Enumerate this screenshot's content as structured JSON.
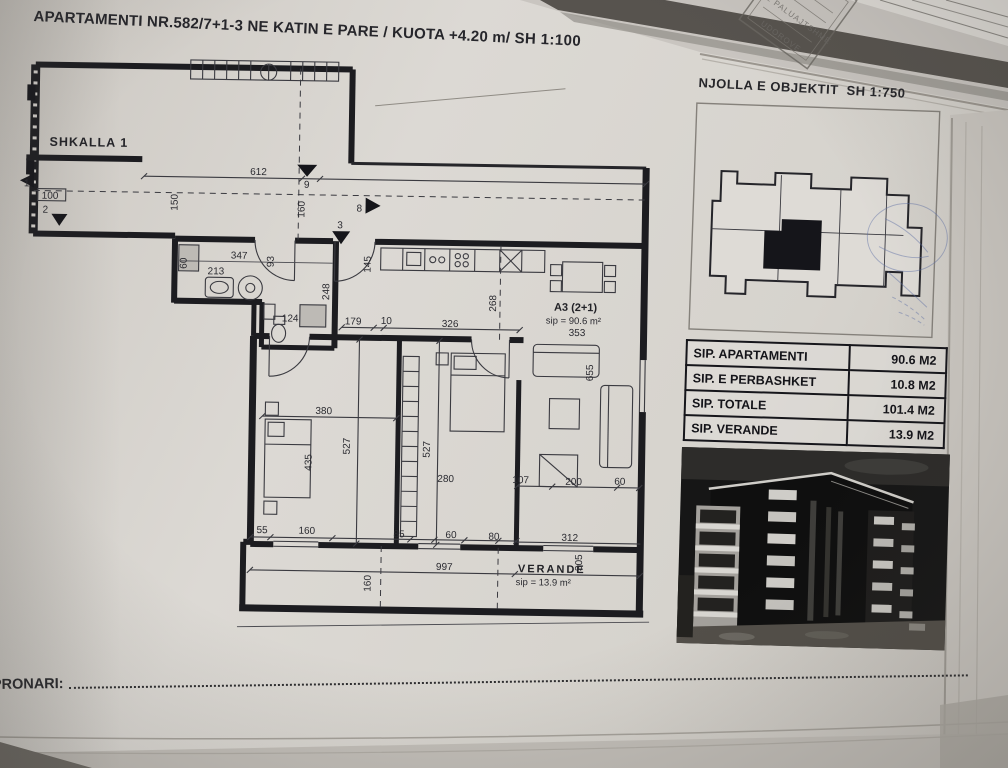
{
  "page": {
    "title_main": "APARTAMENTI NR.582/7+1-3 NE KATIN E PARE  / KUOTA +4.20 m/ ",
    "title_scale": "SH 1:100",
    "pronari_label": "PRONARI:"
  },
  "plan": {
    "stair_label": "SHKALLA 1",
    "unit_code": "A3 (2+1)",
    "unit_area": "sip = 90.6 m²",
    "verande_label": "VERANDE",
    "verande_area": "sip = 13.9 m²",
    "dims": {
      "d612": "612",
      "d9": "9",
      "d150": "150",
      "d160": "160",
      "d8": "8",
      "d3": "3",
      "d1": "1",
      "d100": "100",
      "d2": "2",
      "d347": "347",
      "d213": "213",
      "d60": "60",
      "d93": "93",
      "d145": "145",
      "d248": "248",
      "d124": "124",
      "d179": "179",
      "d10": "10",
      "d326": "326",
      "d353": "353",
      "d268": "268",
      "d655": "655",
      "d380": "380",
      "d435": "435",
      "d527a": "527",
      "d527b": "527",
      "d280": "280",
      "d107": "107",
      "d200": "200",
      "d60b": "60",
      "d55": "55",
      "d160b": "160",
      "d85": "85",
      "d60c": "60",
      "d80": "80",
      "d312": "312",
      "d305": "305",
      "d997": "997",
      "d160c": "160"
    }
  },
  "site": {
    "heading": "NJOLLA E OBJEKTIT",
    "scale": "SH 1:750"
  },
  "summary_table": {
    "rows": [
      {
        "label": "SIP. APARTAMENTI",
        "value": "90.6 M2"
      },
      {
        "label": "SIP. E PERBASHKET",
        "value": "10.8 M2"
      },
      {
        "label": "SIP. TOTALE",
        "value": "101.4 M2"
      },
      {
        "label": "SIP. VERANDE",
        "value": "13.9 M2"
      }
    ]
  },
  "stamp": {
    "line1": "E PALUAJTSHME",
    "line2": "UDOROVE"
  }
}
